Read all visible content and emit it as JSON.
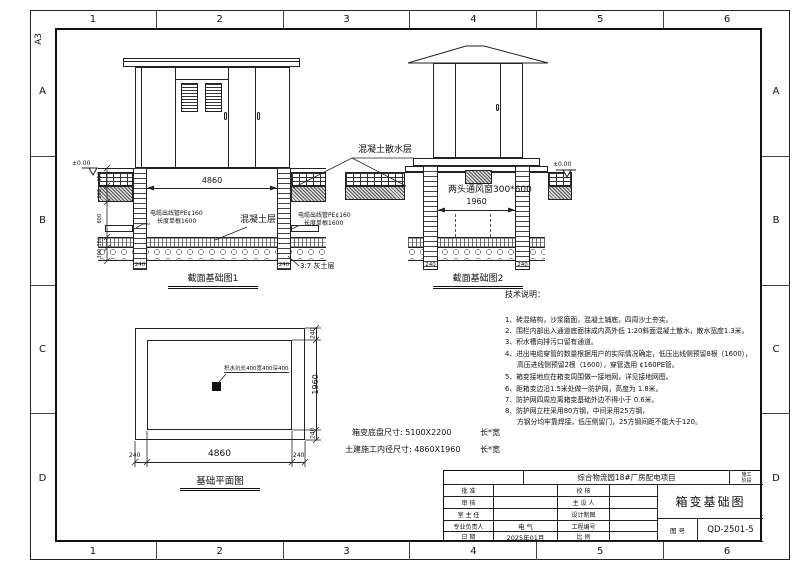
{
  "colors": {
    "ink": "#1a1a1a",
    "paper": "#ffffff"
  },
  "sheet": {
    "format": "A3",
    "top_zone_numbers": [
      "1",
      "2",
      "3",
      "4",
      "5",
      "6"
    ],
    "bottom_zone_numbers": [
      "1",
      "2",
      "3",
      "4",
      "5",
      "6"
    ],
    "left_zone_letters": [
      "A",
      "B",
      "C",
      "D"
    ],
    "right_zone_letters": [
      "A",
      "B",
      "C",
      "D"
    ]
  },
  "section1": {
    "title": "截面基础图1",
    "level_marker": "±0.00",
    "dim_inner_width": "4860",
    "vdims": [
      "150",
      "300",
      "800",
      "150",
      "300"
    ],
    "cable_left_line1": "电缆出线管PE¢160",
    "cable_left_line2": "长度单根1600",
    "cable_right_line1": "电缆出线管PE¢160",
    "cable_right_line2": "长度单根1600",
    "concrete_label": "混凝土层",
    "lime_label": "3:7 灰土层",
    "col_dim_left": "240",
    "col_dim_right": "240"
  },
  "section2": {
    "title": "截面基础图2",
    "level_marker": "±0.00",
    "vent_label": "两头通风窗300*600",
    "dim_inner_width": "1960",
    "col_dim_left": "240",
    "col_dim_right": "240"
  },
  "apron_label": "混凝土散水层",
  "plan": {
    "title": "基础平面图",
    "sump_label": "积水坑长400宽400深400",
    "dim_bottom_left": "240",
    "dim_bottom_center": "4860",
    "dim_bottom_right": "240",
    "dim_right_top": "240",
    "dim_right_center": "1960",
    "dim_right_bottom": "240"
  },
  "size_notes": {
    "line1_label": "箱变底盘尺寸: 5100X2200",
    "line1_unit": "长*宽",
    "line2_label": "土建施工内径尺寸: 4860X1960",
    "line2_unit": "长*宽"
  },
  "tech_notes": {
    "title": "技术说明：",
    "lines": [
      "1、砖混结构，沙浆磨面，混凝土铺底，四周沙土夯实。",
      "2、围栏内部出入通道底面抹成内高外低 1:20斜面混凝土散水，散水宽度1.3米。",
      "3、积水槽向排污口留有通道。",
      "4、进出电缆穿管的数量根据用户的实际情况确定，低压出线侧预留8根（1600），",
      "高压进线侧预留2根（1600），穿管选用 ¢160PE管。",
      "5、箱变接地应在箱变周围做一接地网，详见接地网图。",
      "6、距箱变边沿1.5米处做一防护网，高度为 1.8米。",
      "7、防护网四周应离箱变基础外边不得小于 0.6米。",
      "8、防护网立柱采用80方钢，中间采用25方钢，",
      "方钢分均牢靠焊接，低压侧留门，25方钢间距不能大于120。"
    ]
  },
  "titleblock": {
    "project": "综合物流园18#厂房配电项目",
    "stage_line1": "施工",
    "stage_line2": "阶段",
    "left_rows": [
      {
        "label": "批  准",
        "value": ""
      },
      {
        "label": "审  核",
        "value": ""
      },
      {
        "label": "室 主 任",
        "value": ""
      },
      {
        "label": "专业负责人",
        "value": "电 气"
      },
      {
        "label": "日  期",
        "value": "2025年01月"
      }
    ],
    "mid_rows": [
      {
        "label": "校  核",
        "value": ""
      },
      {
        "label": "主 设 人",
        "value": ""
      },
      {
        "label": "设计制图",
        "value": ""
      },
      {
        "label": "工程编号",
        "value": ""
      },
      {
        "label": "比  例",
        "value": ""
      }
    ],
    "drawing_title": "箱变基础图",
    "number_label": "图  号",
    "number_value": "QD-2501-5"
  }
}
